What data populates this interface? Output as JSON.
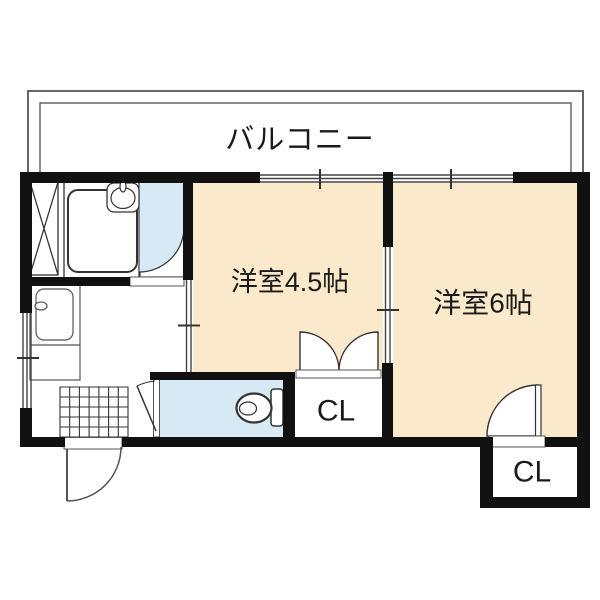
{
  "plan": {
    "balcony": {
      "label": "バルコニー"
    },
    "rooms": [
      {
        "label": "洋室4.5帖"
      },
      {
        "label": "洋室6帖"
      }
    ],
    "closets": [
      {
        "label": "CL"
      },
      {
        "label": "CL"
      }
    ],
    "colors": {
      "room_fill": "#FBE9CB",
      "wet_floor_fill": "#D6E9F5",
      "wall": "#111111",
      "line": "#333333",
      "balcony_line": "#666666"
    },
    "fixtures": [
      "bathtub",
      "washbasin",
      "toilet",
      "kitchen-sink",
      "entrance-tile-grid",
      "pipe-shaft"
    ]
  }
}
